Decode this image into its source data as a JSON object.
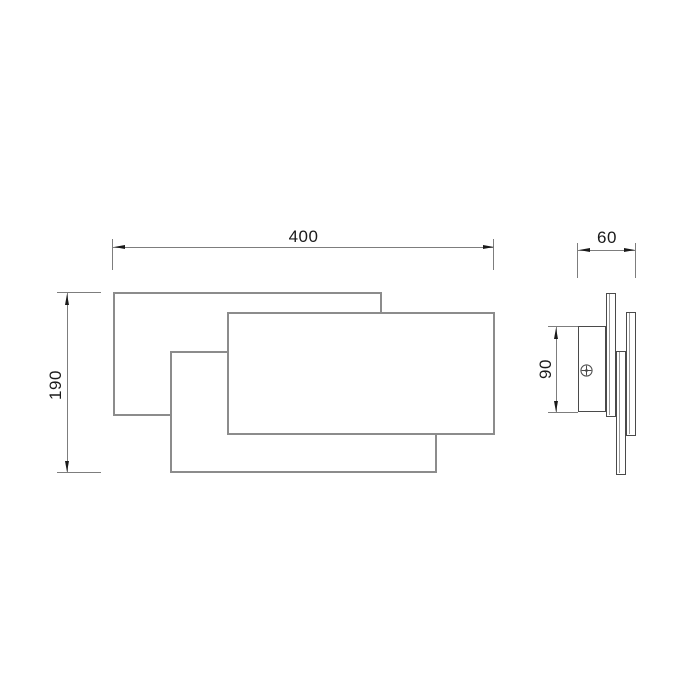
{
  "drawing": {
    "type": "technical-dimension-drawing",
    "subject": "wall-lamp-two-view-drawing",
    "background": "#ffffff"
  },
  "dimensions": {
    "width": {
      "label": "400",
      "view": "front",
      "orientation": "horizontal"
    },
    "height": {
      "label": "190",
      "view": "front",
      "orientation": "vertical"
    },
    "depth": {
      "label": "60",
      "view": "side",
      "orientation": "horizontal"
    },
    "bracket_height": {
      "label": "90",
      "view": "side",
      "orientation": "vertical"
    }
  },
  "icons": {
    "screw": "phillips-screw-head-icon"
  },
  "colors": {
    "outline_front": "#8c8c8c",
    "outline_side": "#4a4a4a",
    "dimension_line": "#7d7d7d",
    "arrow_and_text": "#1a1a1a",
    "background": "#ffffff"
  }
}
